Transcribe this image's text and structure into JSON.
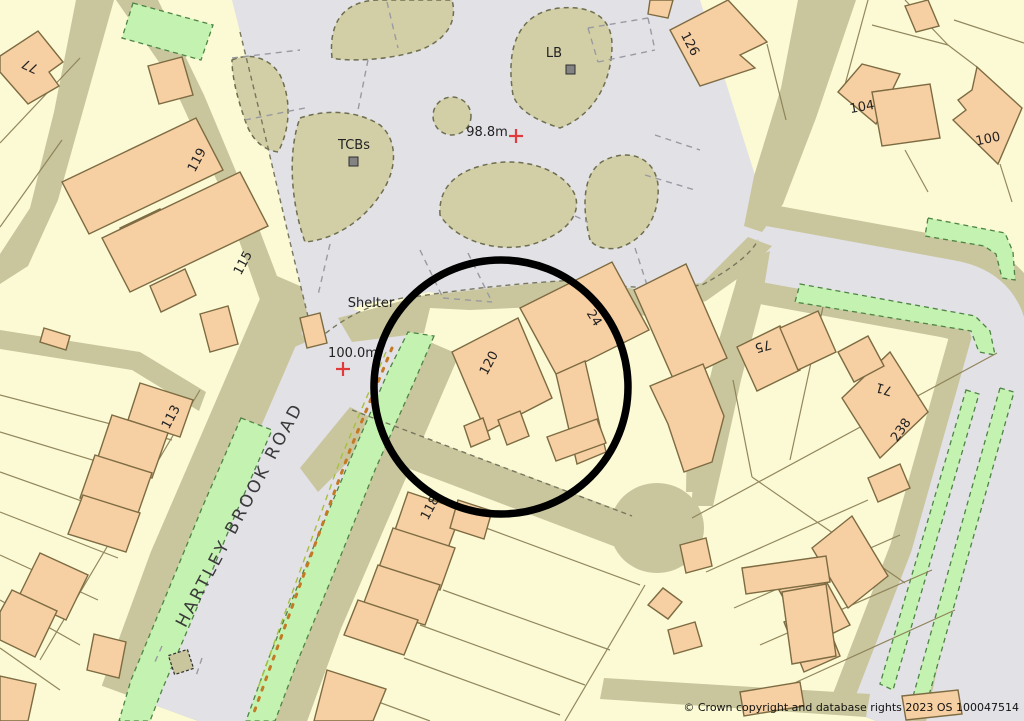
{
  "map": {
    "road_label": "HARTLEY BROOK ROAD",
    "poi": {
      "shelter": "Shelter",
      "tcbs": "TCBs",
      "lb": "LB"
    },
    "spot_heights": {
      "north": "98.8m",
      "south": "100.0m"
    },
    "houses": {
      "h77": "77",
      "h119": "119",
      "h115": "115",
      "h113": "113",
      "h118": "118",
      "h120": "120",
      "h24": "24",
      "h126": "126",
      "h104": "104",
      "h100": "100",
      "h75": "75",
      "h71": "71",
      "h238": "238"
    },
    "copyright": "© Crown copyright and database rights 2023 OS 100047514",
    "highlight": {
      "shape": "circle",
      "purpose": "property-location-highlight",
      "color": "#000000"
    },
    "colors": {
      "base": "#FBFAD4",
      "road": "#E2E1E6",
      "verge": "#C9C69D",
      "veg": "#D2CFA6",
      "veg-edge": "#6e6e50",
      "green": "#C4F2B0",
      "green-edge": "#4e8446",
      "bfill": "#F6CFA3",
      "bstroke": "#7d6b42",
      "parcel": "#8d8157",
      "red": "#E03A3A",
      "text": "#222222",
      "hl": "#000000"
    }
  }
}
